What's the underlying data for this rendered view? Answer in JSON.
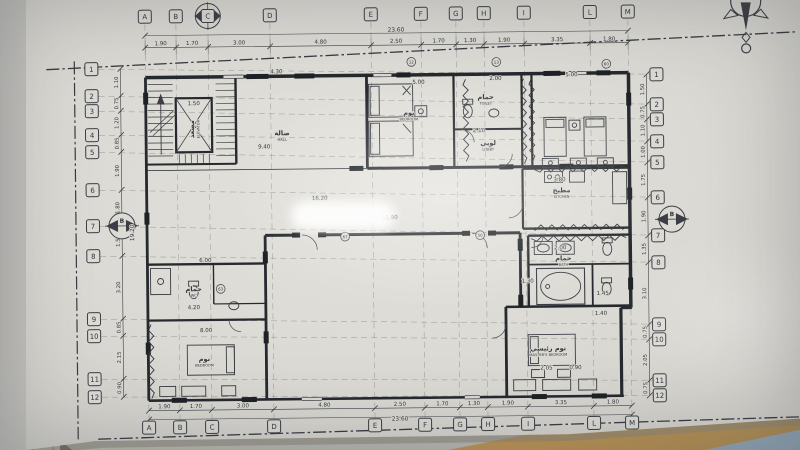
{
  "document": {
    "type": "Architectural floor plan (photographed blueprint)",
    "view": "Floor plan with structural grid and dimensions"
  },
  "grid": {
    "columns": [
      "A",
      "B",
      "C",
      "D",
      "E",
      "F",
      "G",
      "H",
      "I",
      "L",
      "M"
    ],
    "rows": [
      "1",
      "2",
      "3",
      "4",
      "5",
      "6",
      "7",
      "8",
      "9",
      "10",
      "11",
      "12"
    ]
  },
  "dimensions": {
    "overall_width": "23.60",
    "overall_width_bottom": "23.60",
    "overall_height": "19.20",
    "top": [
      "1.90",
      "1.70",
      "3.00",
      "4.80",
      "2.50",
      "1.70",
      "1.30",
      "1.90",
      "3.35",
      "1.80"
    ],
    "bottom": [
      "1.90",
      "1.70",
      "3.00",
      "4.80",
      "2.50",
      "1.70",
      "1.30",
      "1.90",
      "3.35",
      "1.80"
    ],
    "left": [
      "1.10",
      "0.75",
      "1.20",
      "0.85",
      "1.90",
      "1.80",
      "1.50",
      "3.20",
      "0.85",
      "2.15",
      "0.90"
    ],
    "right": [
      "1.50",
      "0.75",
      "1.10",
      "1.00",
      "1.75",
      "1.90",
      "1.35",
      "3.10",
      "0.75",
      "2.05",
      "0.75"
    ],
    "interior": [
      "4.30",
      "1.50",
      "5.00",
      "2.00",
      "5.00",
      "2.10",
      "3.80",
      "2.00",
      "1.30",
      "1.45",
      "6.00",
      "4.20",
      "8.00",
      "16.20",
      "11.90",
      "9.40",
      "2.05",
      "0.90",
      "1.40"
    ]
  },
  "rooms": [
    {
      "name_ar": "صالة",
      "name_en": "HALL"
    },
    {
      "name_ar": "نوم",
      "name_en": "BEDROOM"
    },
    {
      "name_ar": "حمام",
      "name_en": "TOILET"
    },
    {
      "name_ar": "لوبي",
      "name_en": "LOBBY"
    },
    {
      "name_ar": "مطبخ",
      "name_en": "KITCHEN"
    },
    {
      "name_ar": "حمام",
      "name_en": "BATH"
    },
    {
      "name_ar": "نوم رئيسي",
      "name_en": "MASTER'S BEDROOM"
    },
    {
      "name_ar": "حمام",
      "name_en": "WC"
    },
    {
      "name_ar": "نوم",
      "name_en": "BEDROOM"
    },
    {
      "name_ar": "مصعد",
      "name_en": "ELEVATOR"
    }
  ],
  "wall_tags": [
    "12",
    "13",
    "63",
    "67",
    "50",
    "60"
  ],
  "section_markers": {
    "left": "B",
    "right": "B"
  },
  "symbols": {
    "north_arrow": "north-arrow-at-grid-C",
    "compass_rose": "compass-rose-top-right"
  },
  "colors": {
    "paper": "#dcdad4",
    "ink": "#3b3e44",
    "wall": "#26292e",
    "table_surface": "#c49a5e",
    "background": "#c6c5c1",
    "shadow": "#514c44",
    "corner_blue": "#8fa3b2"
  }
}
